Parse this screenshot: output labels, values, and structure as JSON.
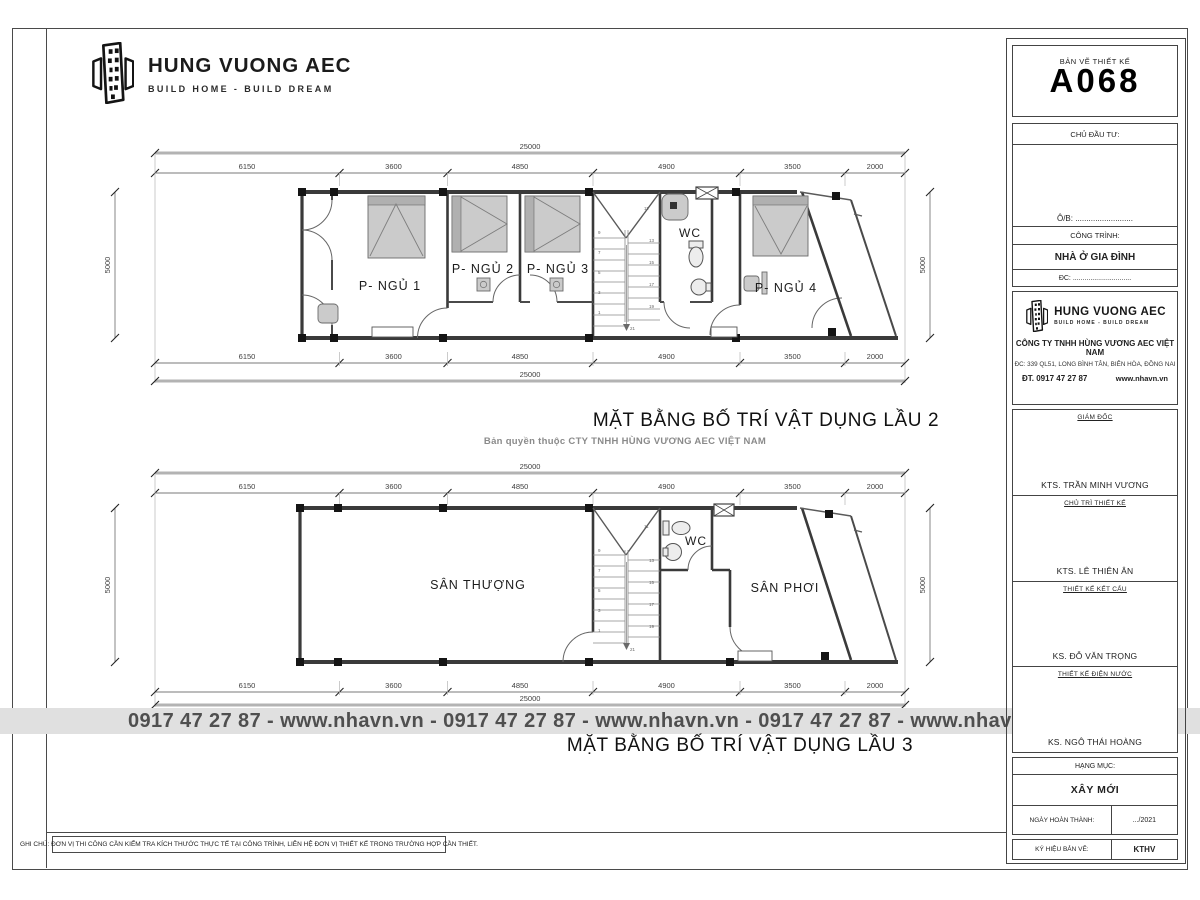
{
  "logo": {
    "name": "HUNG VUONG AEC",
    "tagline": "BUILD HOME - BUILD DREAM"
  },
  "watermark": "0917 47 27 87 - www.nhavn.vn - 0917 47 27 87 - www.nhavn.vn - 0917 47 27 87 - www.nhavn.vn",
  "footer_note": "GHI CHÚ: ĐƠN VỊ THI CÔNG CẦN KIỂM TRA KÍCH THƯỚC THỰC TẾ TẠI CÔNG TRÌNH, LIÊN HỆ ĐƠN VỊ THIẾT KẾ TRONG TRƯỜNG HỢP CẦN THIẾT.",
  "dims": {
    "total": "25000",
    "segments": [
      "6150",
      "3600",
      "4850",
      "4900",
      "3500",
      "2000"
    ],
    "side": "5000"
  },
  "stair_numbers": {
    "left": [
      "9",
      "7",
      "5",
      "3",
      "1"
    ],
    "right": [
      "11",
      "13",
      "15",
      "17",
      "19"
    ],
    "last": "21"
  },
  "plan2f": {
    "title": "MẶT BẰNG BỐ TRÍ VẬT DỤNG LẦU 2",
    "subtitle": "Bản quyền thuộc CTY TNHH HÙNG VƯƠNG AEC VIỆT NAM",
    "rooms": {
      "bed1": "P- NGỦ 1",
      "bed2": "P- NGỦ 2",
      "bed3": "P- NGỦ 3",
      "wc": "WC",
      "bed4": "P- NGỦ 4"
    }
  },
  "plan3f": {
    "title": "MẶT BẰNG BỐ TRÍ VẬT DỤNG LẦU 3",
    "rooms": {
      "terrace": "SÂN THƯỢNG",
      "wc": "WC",
      "drying": "SÂN PHƠI"
    }
  },
  "titleblock": {
    "drawing_label": "BẢN VẼ THIẾT KẾ",
    "drawing_number": "A068",
    "client_label": "CHỦ ĐẦU TƯ:",
    "ob_line": "Ô/B: ..........................",
    "project_label": "CÔNG TRÌNH:",
    "project_name": "NHÀ Ở GIA ĐÌNH",
    "address_line": "ĐC: ..............................",
    "company": {
      "name": "CÔNG TY TNHH HÙNG VƯƠNG AEC VIỆT NAM",
      "address": "ĐC: 339 QL51, LONG BÌNH TÂN, BIÊN HÒA, ĐỒNG NAI",
      "phone": "ĐT. 0917 47 27 87",
      "website": "www.nhavn.vn"
    },
    "signatures": [
      {
        "role": "GIÁM ĐỐC",
        "name": "KTS. TRẦN MINH VƯƠNG"
      },
      {
        "role": "CHỦ TRÌ THIẾT KẾ",
        "name": "KTS. LÊ THIÊN ÂN"
      },
      {
        "role": "THIẾT KẾ KẾT CẤU",
        "name": "KS. ĐỖ VĂN TRỌNG"
      },
      {
        "role": "THIẾT KẾ ĐIỆN NƯỚC",
        "name": "KS. NGÔ THÁI HOÀNG"
      }
    ],
    "category_label": "HẠNG MỤC:",
    "category_value": "XÂY MỚI",
    "date_label": "NGÀY HOÀN THÀNH:",
    "date_value": ".../2021",
    "code_label": "KÝ HIỆU BẢN VẼ:",
    "code_value": "KTHV"
  },
  "colors": {
    "watermark_bg": "#e0e0e0",
    "watermark_text": "#4f4f4f",
    "wall": "#3a3a3a",
    "furniture": "#cbcbcb",
    "column": "#151515"
  }
}
